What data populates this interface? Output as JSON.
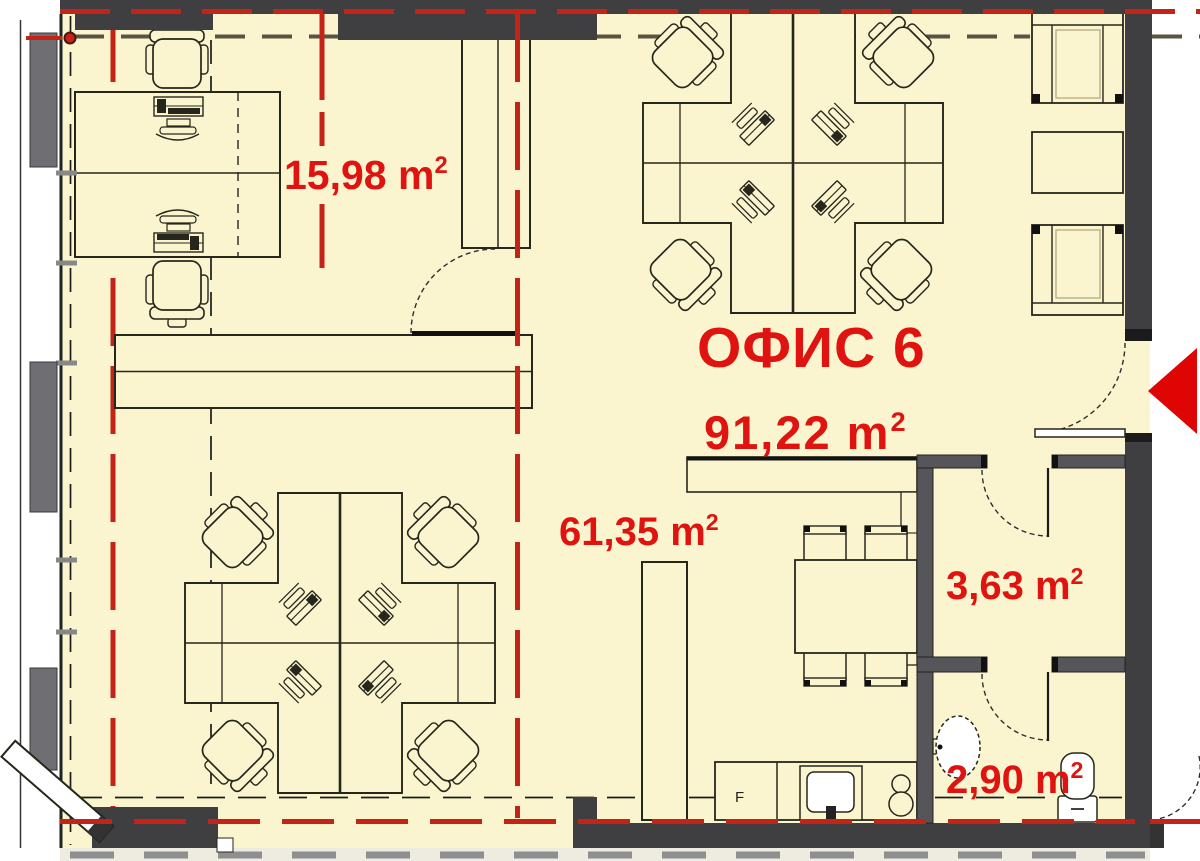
{
  "floor_plan": {
    "title": {
      "text": "ОФИС 6"
    },
    "main_area": {
      "value": "91,22",
      "unit_base": "m",
      "unit_exp": "2"
    },
    "rooms": [
      {
        "key": "meeting_room",
        "label": {
          "value": "15,98",
          "unit_base": "m",
          "unit_exp": "2"
        }
      },
      {
        "key": "open_space",
        "label": {
          "value": "61,35",
          "unit_base": "m",
          "unit_exp": "2"
        }
      },
      {
        "key": "storage",
        "label": {
          "value": "3,63",
          "unit_base": "m",
          "unit_exp": "2"
        }
      },
      {
        "key": "wc",
        "label": {
          "value": "2,90",
          "unit_base": "m",
          "unit_exp": "2"
        }
      }
    ],
    "appliances": {
      "fridge_label": "F"
    },
    "colors": {
      "floor": "#FBF5CF",
      "wall": "#3F3F41",
      "wall_interior": "#55555A",
      "pillar": "#6F6F73",
      "red_line": "#C42418",
      "label_red": "#DF1310",
      "furniture_ink": "#26261C",
      "tan_dash": "#5A5342",
      "outside_strip": "#EEEBE1",
      "arrow_red": "#E00505"
    }
  }
}
